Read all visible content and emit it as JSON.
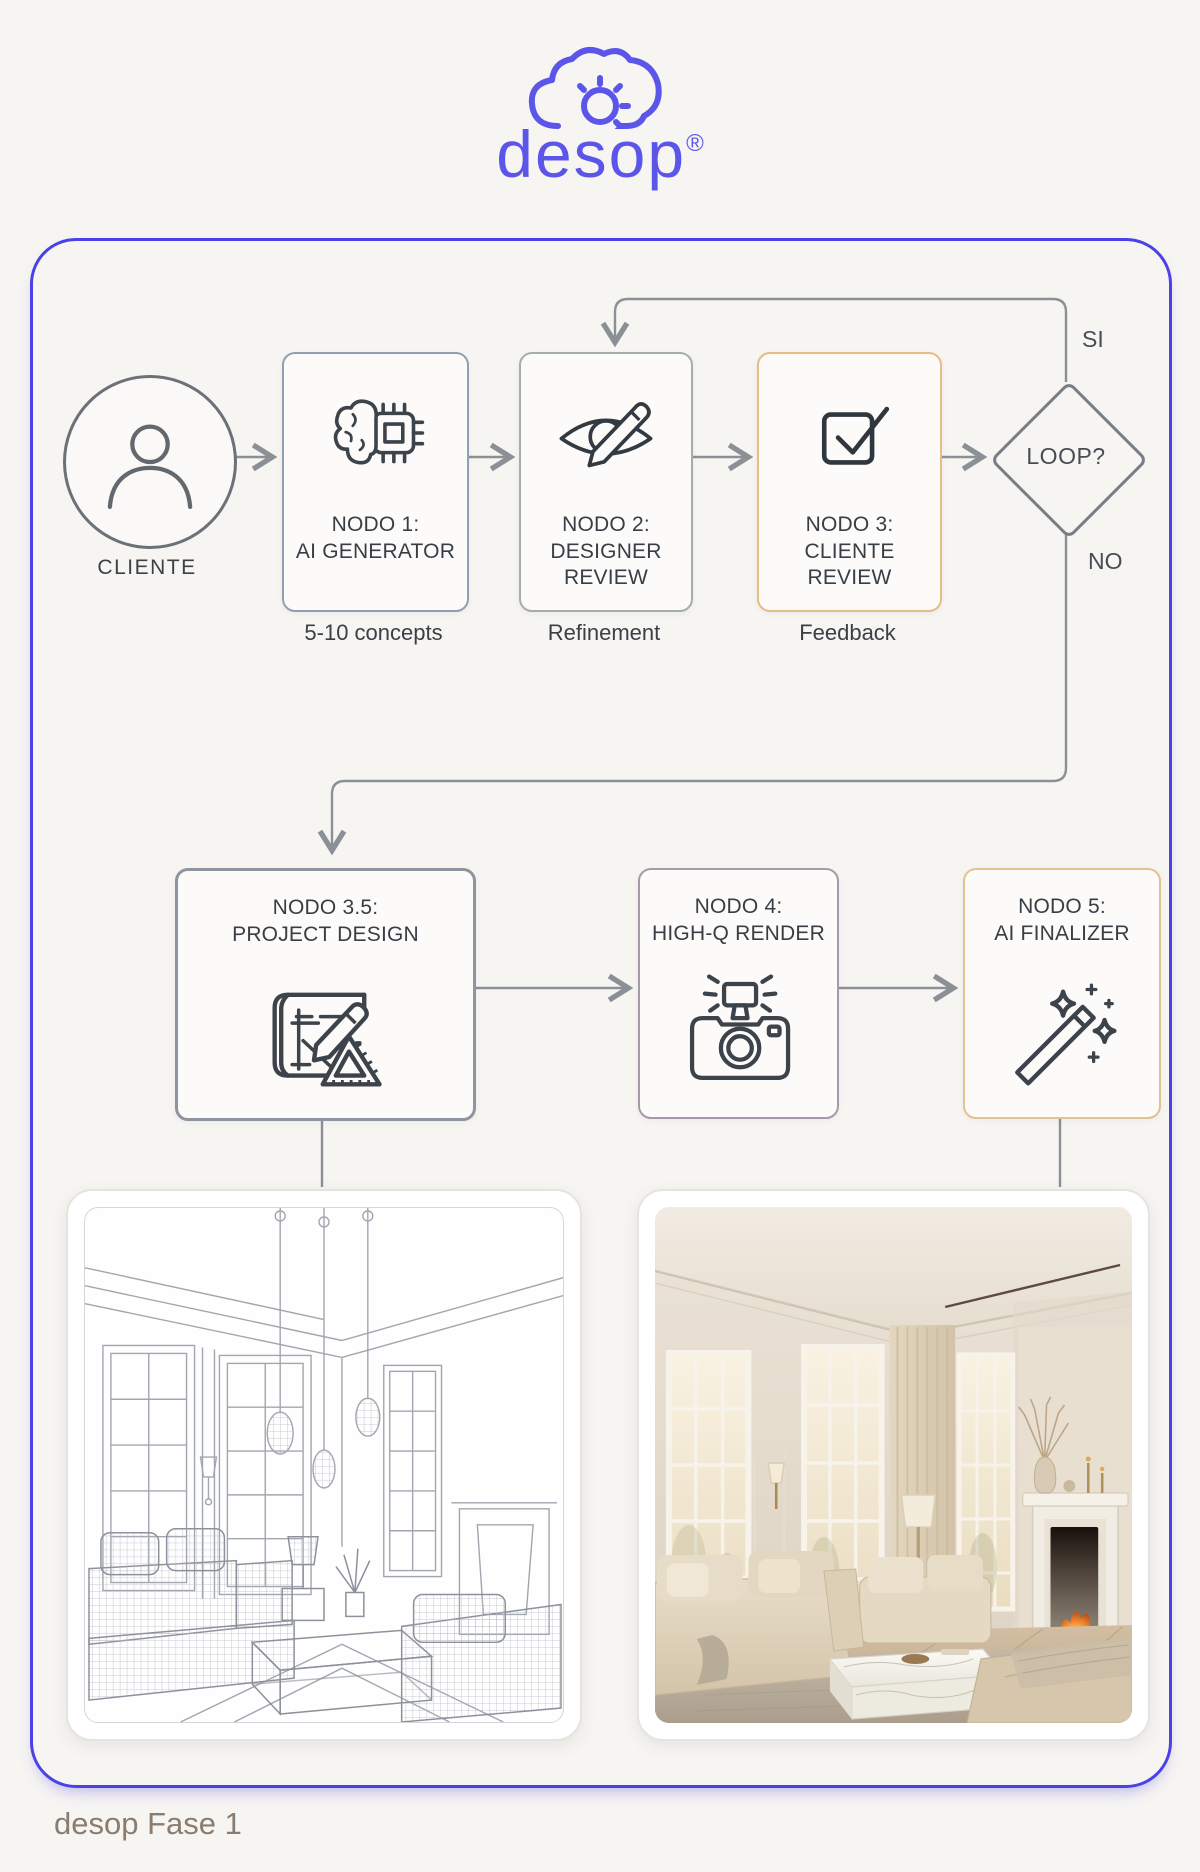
{
  "logo": {
    "wordmark": "desop",
    "registered": "®"
  },
  "diagram": {
    "cliente_label": "CLIENTE",
    "row1": {
      "nodo1": {
        "t1": "NODO 1:",
        "t2": "AI GENERATOR",
        "sub": "5-10 concepts"
      },
      "nodo2": {
        "t1": "NODO 2:",
        "t2": "DESIGNER",
        "t3": "REVIEW",
        "sub": "Refinement"
      },
      "nodo3": {
        "t1": "NODO 3:",
        "t2": "CLIENTE",
        "t3": "REVIEW",
        "sub": "Feedback"
      }
    },
    "decision": {
      "label": "LOOP?",
      "yes": "SI",
      "no": "NO"
    },
    "row2": {
      "nodo35": {
        "t1": "NODO 3.5:",
        "t2": "PROJECT DESIGN"
      },
      "nodo4": {
        "t1": "NODO 4:",
        "t2": "HIGH-Q RENDER"
      },
      "nodo5": {
        "t1": "NODO 5:",
        "t2": "AI FINALIZER"
      }
    }
  },
  "footer": {
    "caption": "desop Fase 1"
  },
  "colors": {
    "brand_purple": "#5b55e9",
    "frame_blue": "#4a42e6",
    "nodo1_border": "#8fa0b3",
    "nodo2_border": "#a6afa6",
    "nodo3_border": "#e5bd85",
    "nodo35_border": "#8e959e",
    "nodo4_border": "#a899aa",
    "nodo5_border": "#e0c490",
    "connector_gray": "#8a9096",
    "text_dark": "#383e45",
    "caption_brown": "#8a7d70"
  }
}
